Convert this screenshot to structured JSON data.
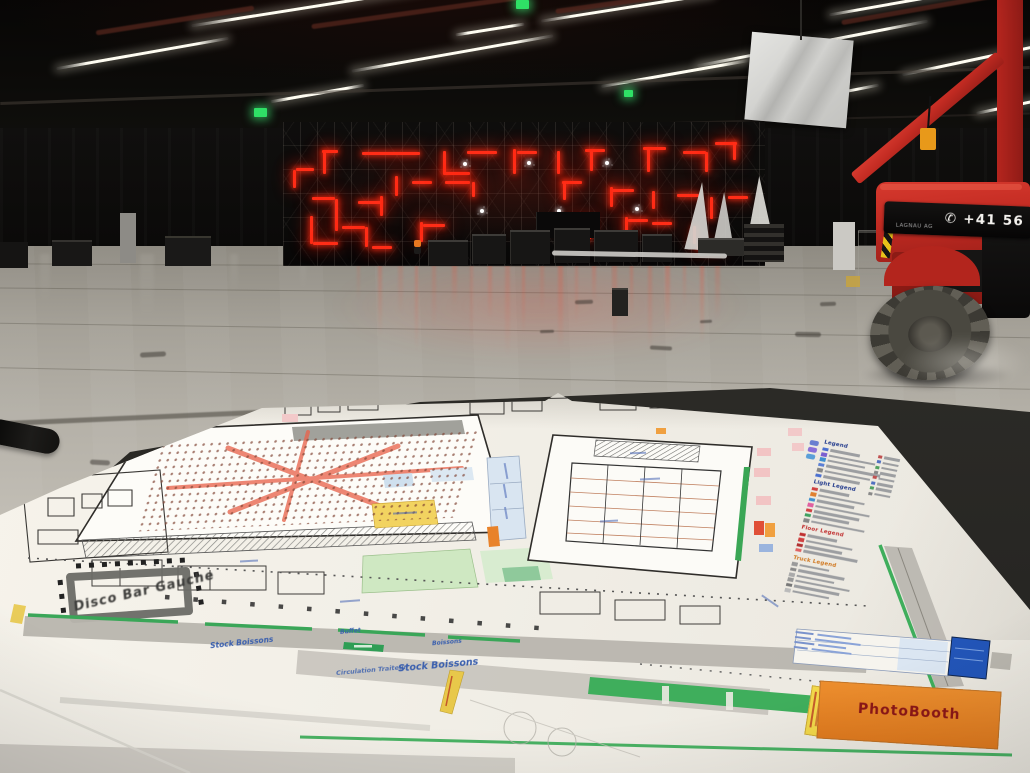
{
  "scene": {
    "description": "Exhibition hall during event build-up: scaffolding stage with red LED light pattern, red boom lift, and a printed floor plan lying in the foreground",
    "colors": {
      "led_red": "#ff2d17",
      "machine_red": "#c22b22",
      "plan_green": "#3fae5c",
      "plan_orange": "#e8872a",
      "exit_green": "#2fe066",
      "paper": "#f2efe7"
    }
  },
  "machine": {
    "phone": "+41 56",
    "phone_icon": "✆",
    "brand": "LAGNAU AG"
  },
  "plan": {
    "labels": {
      "disco_bar": "Disco Bar Gauche",
      "stock_boissons_1": "Stock Boissons",
      "stock_boissons_2": "Stock Boissons",
      "circulation_traiteur": "Circulation Traiteur",
      "buffet": "Buffet",
      "boissons": "Boissons",
      "photobooth": "PhotoBooth"
    },
    "legend": {
      "headings": [
        "Legend",
        "Light Legend",
        "Floor Legend",
        "Truck Legend"
      ]
    }
  }
}
